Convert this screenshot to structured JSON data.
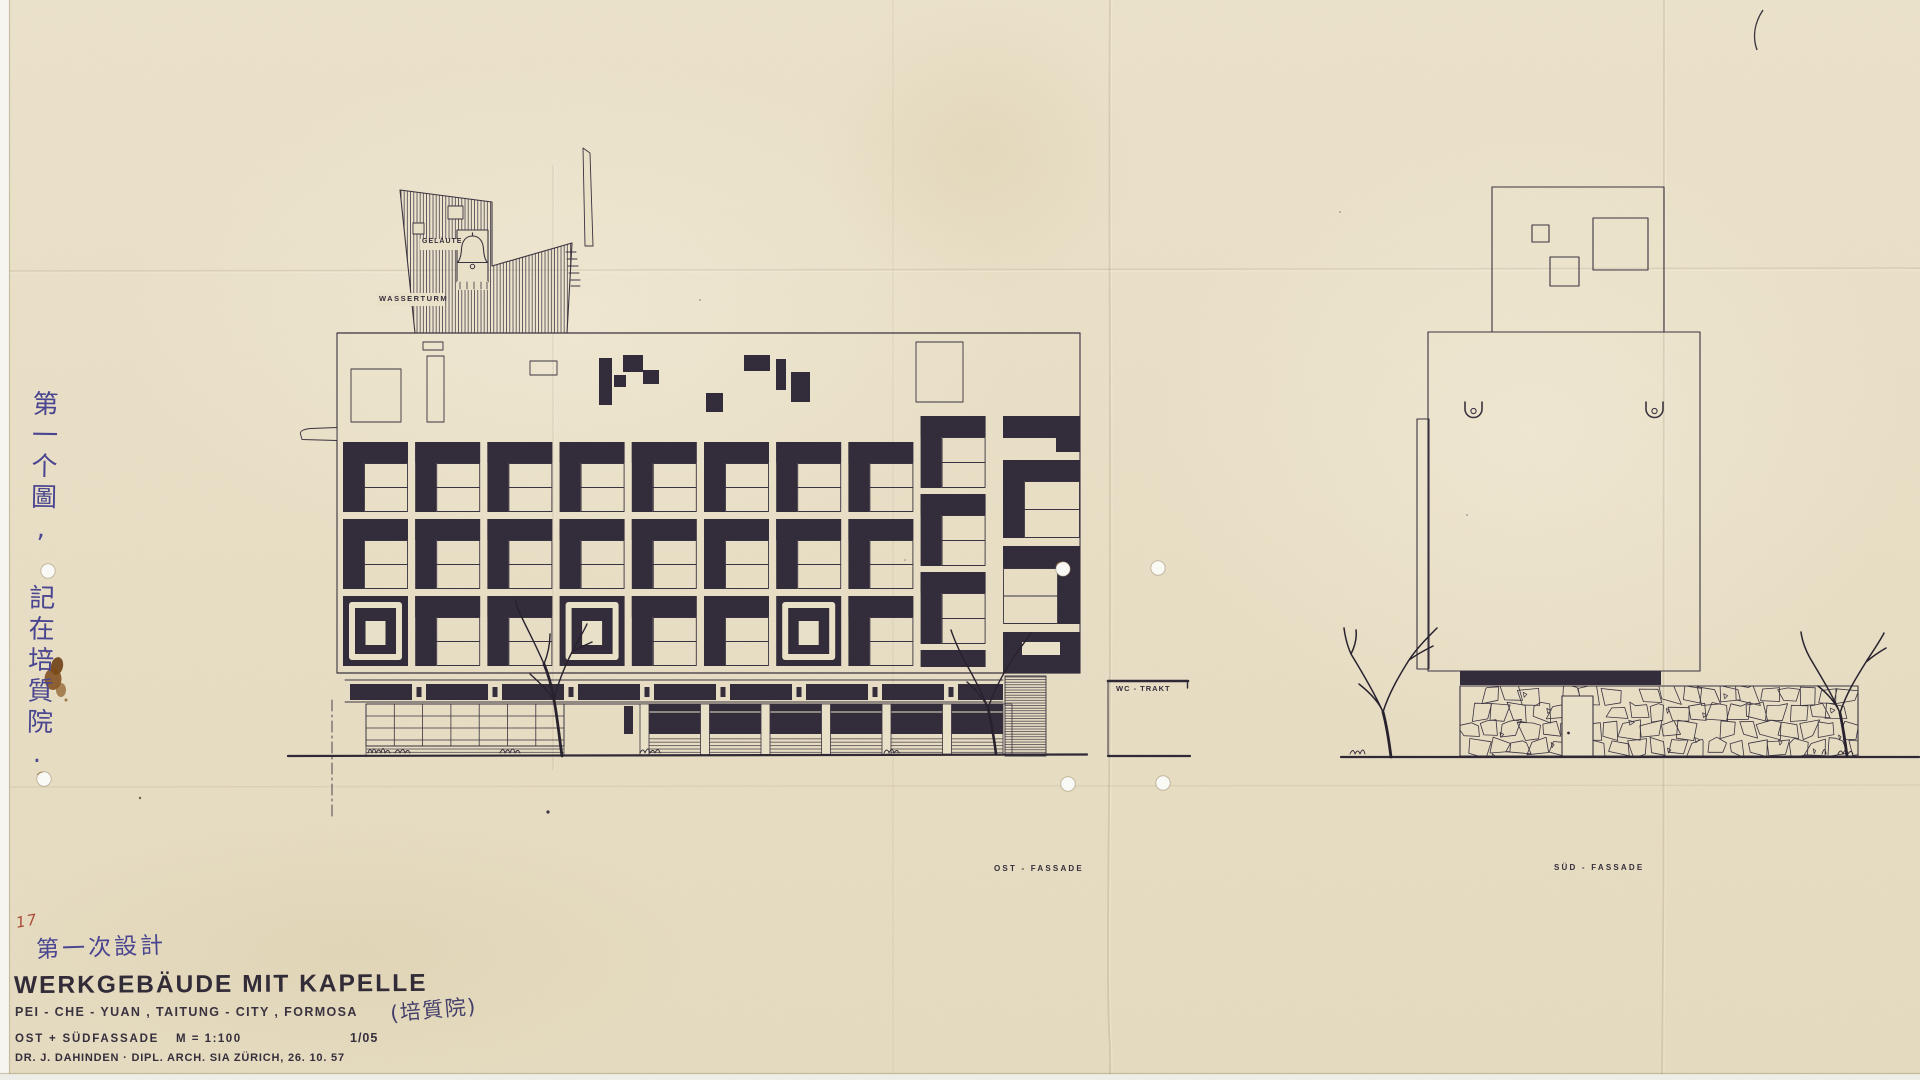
{
  "document": {
    "sheet_number_handwritten": "17",
    "first_design_note": "第一次設計",
    "side_note_vertical": "第一个圖, 記在培質院.",
    "title": "WERKGEBÄUDE MIT KAPELLE",
    "location_line": "PEI - CHE - YUAN , TAITUNG - CITY , FORMOSA",
    "location_note_chinese": "(培質院)",
    "facade_line": "OST + SÜDFASSADE",
    "scale": "M = 1:100",
    "sheet_ref": "1/05",
    "architect_line": "DR. J. DAHINDEN   ·   DIPL. ARCH. SIA   ZÜRICH, 26. 10. 57"
  },
  "annotations": {
    "bell_label": "GELÄUTE",
    "water_tower_label": "WASSERTURM",
    "wc_label": "WC - TRAKT",
    "east_label": "OST - FASSADE",
    "south_label": "SÜD - FASSADE"
  },
  "icons": {
    "bell-icon": "church bell in belfry opening",
    "scupper-hook-icon": "U-shaped roof scupper symbol",
    "bare-tree": "leafless tree sketch",
    "punch-hole": "binder punch hole",
    "ink-stain": "brown stain blot"
  },
  "colors": {
    "paper": "#e9e0c8",
    "ink": "#332c3a",
    "ink_line": "#3a3340",
    "handwriting_ink": "#4a4590",
    "red_pencil": "#a84b35",
    "stain_brown": "#7c4a1a"
  }
}
